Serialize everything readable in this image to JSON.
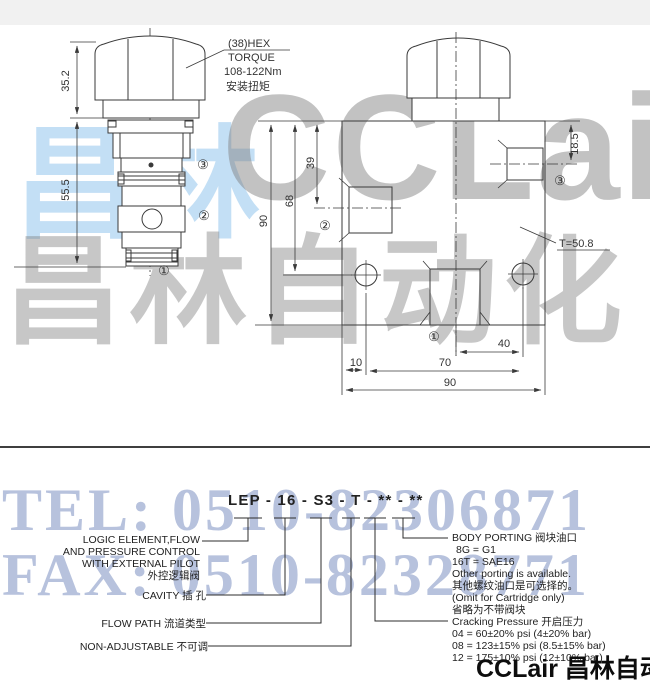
{
  "watermark": {
    "blue_text": "昌林",
    "brand_text": "CCLair",
    "cn_text": "昌林自动化",
    "tel_text": "TEL: 0510-82306871",
    "fax_text": "FAX: 0510-82328771",
    "blue_color": "#c9e2f4",
    "gray_color": "#9a9a9a",
    "telfax_color": "#8fa3d0"
  },
  "left_drawing": {
    "dim_hex_height": "35.2",
    "dim_body_height": "55.5",
    "hex_note": [
      "(38)HEX",
      "TORQUE",
      "108-122Nm",
      "安装扭矩"
    ],
    "port1": "①",
    "port2": "②",
    "port3": "③"
  },
  "right_drawing": {
    "dim_height": "90",
    "dim_68": "68",
    "dim_39": "39",
    "dim_18_5": "18.5",
    "thickness_note": "T=50.8",
    "dim_40": "40",
    "dim_10": "10",
    "dim_70": "70",
    "dim_width": "90",
    "port1": "①",
    "port2": "②",
    "port3": "③"
  },
  "model_code": {
    "code": "LEP - 16 - S3 - T - ** - **"
  },
  "callouts": {
    "function": {
      "lines": [
        "LOGIC ELEMENT,FLOW",
        "AND PRESSURE CONTROL",
        "WITH EXTERNAL PILOT",
        "外控逻辑阀"
      ]
    },
    "cavity": "CAVITY   插 孔",
    "flow_path": "FLOW PATH   流道类型",
    "non_adjustable": "NON-ADJUSTABLE   不可调",
    "body_porting": {
      "lines": [
        "BODY PORTING 阀块油口",
        "8G = G1",
        "16T = SAE16",
        "Other porting is available.",
        "其他螺纹油口是可选择的。",
        "(Omit for Cartridge only)",
        "省略为不带阀块"
      ]
    },
    "cracking_pressure": {
      "lines": [
        "Cracking Pressure  开启压力",
        "04 = 60±20% psi (4±20% bar)",
        "08 = 123±15% psi (8.5±15% bar)",
        "12 = 175±10% psi (12±10% bar)"
      ]
    }
  },
  "footer": {
    "logo": "CCLair 昌林自动化"
  }
}
